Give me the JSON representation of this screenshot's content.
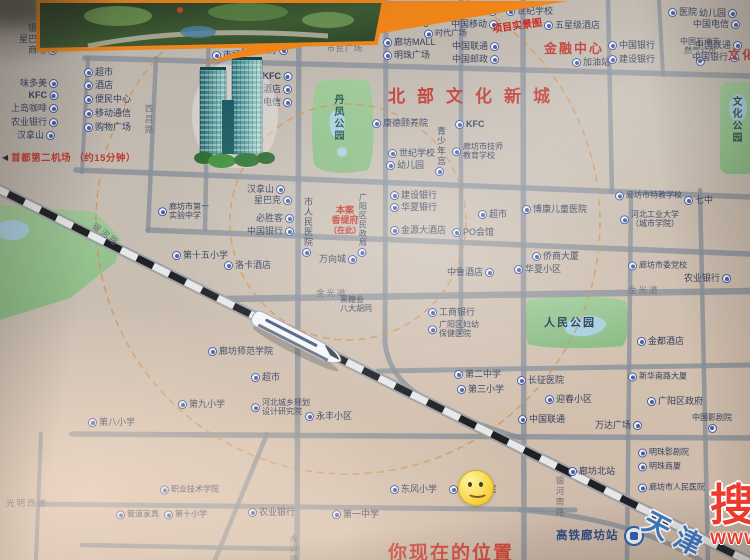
{
  "colors": {
    "red": "#bf3931",
    "poi": "#333f5e",
    "road": "#878e98",
    "park": "#92c38c",
    "pond": "#a8cfe0",
    "orange": "#ef8519",
    "rail_black": "#1f2023",
    "watermark_red": "#ea3b2e",
    "direction_blue": "#3c79c4"
  },
  "titles": {
    "admin": "行政中心",
    "finance": "金融中心",
    "north": "北部文化新城",
    "culture": "文化中心",
    "plaza": "市民广场"
  },
  "star_icon": "★",
  "airport": {
    "arrow": "◀",
    "text": "首都第二机场 （约15分钟）"
  },
  "project": {
    "l1": "本案",
    "l2": "香缇府",
    "l3": "（在此）"
  },
  "parks": {
    "danfeng": "丹凤公园",
    "renmin": "人民公园",
    "wenhua": "文化公园"
  },
  "station": {
    "name": "高铁廊坊站"
  },
  "direction": {
    "name": "天津"
  },
  "location": {
    "text": "你现在的位置"
  },
  "watermark": {
    "char": "搜",
    "www": "WWW"
  },
  "callout": {
    "caption": "项目实景图"
  },
  "streets": [
    {
      "t": "西昌路",
      "x": 143,
      "y": 104,
      "v": 1
    },
    {
      "t": "银河路",
      "x": 97,
      "y": 220,
      "r": 38
    },
    {
      "t": "金光道",
      "x": 316,
      "y": 287
    },
    {
      "t": "金光道",
      "x": 628,
      "y": 284
    },
    {
      "t": "永兴路",
      "x": 288,
      "y": 534,
      "v": 1
    },
    {
      "t": "银河南路",
      "x": 554,
      "y": 476,
      "v": 1
    },
    {
      "t": "光明西道",
      "x": 6,
      "y": 497
    }
  ],
  "pois": [
    {
      "x": 57,
      "y": 29,
      "t": "银行",
      "d": "r"
    },
    {
      "x": 57,
      "y": 40,
      "t": "星巴克",
      "d": "r"
    },
    {
      "x": 57,
      "y": 51,
      "t": "商场",
      "d": "r"
    },
    {
      "x": 86,
      "y": 30,
      "t": "世纪华联",
      "d": "l"
    },
    {
      "x": 86,
      "y": 43,
      "t": "超市",
      "d": "l"
    },
    {
      "x": 190,
      "y": 32,
      "t": "超市",
      "d": "l"
    },
    {
      "x": 212,
      "y": 44,
      "t": "便民中心",
      "d": "l"
    },
    {
      "x": 212,
      "y": 56,
      "t": "市场",
      "d": "l"
    },
    {
      "x": 84,
      "y": 73,
      "t": "超市",
      "d": "l"
    },
    {
      "x": 84,
      "y": 86,
      "t": "酒店",
      "d": "l"
    },
    {
      "x": 58,
      "y": 84,
      "t": "味多美",
      "d": "r"
    },
    {
      "x": 58,
      "y": 96,
      "t": "KFC",
      "d": "r",
      "b": 1
    },
    {
      "x": 58,
      "y": 109,
      "t": "上岛咖啡",
      "d": "r"
    },
    {
      "x": 58,
      "y": 123,
      "t": "农业银行",
      "d": "r"
    },
    {
      "x": 55,
      "y": 136,
      "t": "汉拿山",
      "d": "r"
    },
    {
      "x": 84,
      "y": 100,
      "t": "便民中心",
      "d": "l"
    },
    {
      "x": 84,
      "y": 114,
      "t": "移动通信",
      "d": "l"
    },
    {
      "x": 84,
      "y": 128,
      "t": "购物广场",
      "d": "l"
    },
    {
      "x": 288,
      "y": 10,
      "t": "中国银行",
      "d": "r"
    },
    {
      "x": 288,
      "y": 23,
      "t": "KFC",
      "d": "r",
      "b": 1
    },
    {
      "x": 288,
      "y": 37,
      "t": "上岛咖啡",
      "d": "r"
    },
    {
      "x": 288,
      "y": 51,
      "t": "交通银行",
      "d": "r"
    },
    {
      "x": 292,
      "y": 77,
      "t": "KFC",
      "d": "r",
      "b": 1
    },
    {
      "x": 292,
      "y": 90,
      "t": "酒店",
      "d": "r"
    },
    {
      "x": 292,
      "y": 103,
      "t": "电信",
      "d": "r"
    },
    {
      "x": 383,
      "y": 11,
      "t": "如家酒店",
      "d": "l",
      "s": 1
    },
    {
      "x": 425,
      "y": 11,
      "t": "超市",
      "d": "l",
      "s": 1
    },
    {
      "x": 497,
      "y": 12,
      "t": "幼儿园",
      "d": "r"
    },
    {
      "x": 383,
      "y": 24,
      "t": "便民中心",
      "d": "l"
    },
    {
      "x": 498,
      "y": 25,
      "t": "中国移动",
      "d": "r"
    },
    {
      "x": 424,
      "y": 34,
      "t": "时代广场",
      "d": "l",
      "s": 1
    },
    {
      "x": 383,
      "y": 43,
      "t": "廊坊MALL",
      "d": "l"
    },
    {
      "x": 499,
      "y": 47,
      "t": "中国联通",
      "d": "r"
    },
    {
      "x": 383,
      "y": 56,
      "t": "明珠广场",
      "d": "l"
    },
    {
      "x": 499,
      "y": 60,
      "t": "中国邮政",
      "d": "r"
    },
    {
      "x": 506,
      "y": 12,
      "t": "世纪学校",
      "d": "l"
    },
    {
      "x": 544,
      "y": 26,
      "t": "五星级酒店",
      "d": "l"
    },
    {
      "x": 572,
      "y": 63,
      "t": "加油站",
      "d": "l"
    },
    {
      "x": 668,
      "y": 13,
      "t": "医院",
      "d": "l"
    },
    {
      "x": 608,
      "y": 46,
      "t": "中国银行",
      "d": "l"
    },
    {
      "x": 608,
      "y": 60,
      "t": "建设银行",
      "d": "l"
    },
    {
      "x": 700,
      "y": 38,
      "l": [
        "中国石油天",
        "然气公司"
      ],
      "d": "b",
      "s": 1
    },
    {
      "x": 737,
      "y": 14,
      "t": "幼儿园",
      "d": "r"
    },
    {
      "x": 740,
      "y": 25,
      "t": "中国电信",
      "d": "r"
    },
    {
      "x": 742,
      "y": 46,
      "t": "中国联通",
      "d": "r"
    },
    {
      "x": 739,
      "y": 58,
      "t": "中国银行",
      "d": "r"
    },
    {
      "x": 372,
      "y": 124,
      "t": "康德颐养院",
      "d": "l"
    },
    {
      "x": 455,
      "y": 125,
      "t": "KFC",
      "d": "l",
      "b": 1
    },
    {
      "x": 440,
      "y": 126,
      "t": "青少年宫",
      "d": "b",
      "v": 1
    },
    {
      "x": 388,
      "y": 154,
      "t": "世纪学校",
      "d": "l"
    },
    {
      "x": 386,
      "y": 166,
      "t": "幼儿园",
      "d": "l"
    },
    {
      "x": 452,
      "y": 152,
      "l": [
        "廊坊市技师",
        "教育学校"
      ],
      "d": "l",
      "s": 1
    },
    {
      "x": 158,
      "y": 212,
      "l": [
        "廊坊市第一",
        "实验中学"
      ],
      "d": "l",
      "s": 1
    },
    {
      "x": 172,
      "y": 256,
      "t": "第十五小学",
      "d": "l"
    },
    {
      "x": 208,
      "y": 352,
      "t": "廊坊师范学院",
      "d": "l"
    },
    {
      "x": 285,
      "y": 190,
      "t": "汉拿山",
      "d": "r"
    },
    {
      "x": 292,
      "y": 201,
      "t": "星巴克",
      "d": "r"
    },
    {
      "x": 294,
      "y": 219,
      "t": "必胜客",
      "d": "r"
    },
    {
      "x": 294,
      "y": 232,
      "t": "中国银行",
      "d": "r"
    },
    {
      "x": 307,
      "y": 197,
      "t": "市人民医院",
      "v": 1,
      "d": "b"
    },
    {
      "x": 362,
      "y": 193,
      "t": "广阳区民政局",
      "v": 1,
      "d": "b",
      "s": 1
    },
    {
      "x": 390,
      "y": 196,
      "t": "建设银行",
      "d": "l"
    },
    {
      "x": 390,
      "y": 208,
      "t": "华夏银行",
      "d": "l"
    },
    {
      "x": 390,
      "y": 231,
      "t": "金源大酒店",
      "d": "l"
    },
    {
      "x": 452,
      "y": 233,
      "t": "PO会馆",
      "d": "l"
    },
    {
      "x": 224,
      "y": 266,
      "t": "洛卡酒店",
      "d": "l"
    },
    {
      "x": 357,
      "y": 260,
      "t": "万向城",
      "d": "r"
    },
    {
      "x": 478,
      "y": 215,
      "t": "超市",
      "d": "l"
    },
    {
      "x": 494,
      "y": 273,
      "t": "中鲁酒店",
      "d": "r"
    },
    {
      "x": 340,
      "y": 305,
      "l": [
        "黑糖会",
        "八大胡同"
      ],
      "d": "n",
      "s": 1
    },
    {
      "x": 428,
      "y": 313,
      "t": "工商银行",
      "d": "l"
    },
    {
      "x": 428,
      "y": 330,
      "l": [
        "广阳区妇幼",
        "保健医院"
      ],
      "d": "l",
      "s": 1
    },
    {
      "x": 522,
      "y": 210,
      "t": "博康儿童医院",
      "d": "l"
    },
    {
      "x": 615,
      "y": 196,
      "t": "廊坊市特教学校",
      "d": "l",
      "s": 1
    },
    {
      "x": 684,
      "y": 201,
      "t": "七中",
      "d": "l"
    },
    {
      "x": 620,
      "y": 220,
      "l": [
        "河北工业大学",
        "（城市学院）"
      ],
      "d": "l",
      "s": 1
    },
    {
      "x": 532,
      "y": 257,
      "t": "侨商大厦",
      "d": "l"
    },
    {
      "x": 514,
      "y": 270,
      "t": "华夏小区",
      "d": "l"
    },
    {
      "x": 628,
      "y": 266,
      "t": "廊坊市委党校",
      "d": "l",
      "s": 1
    },
    {
      "x": 731,
      "y": 279,
      "t": "农业银行",
      "d": "r"
    },
    {
      "x": 637,
      "y": 342,
      "t": "金都酒店",
      "d": "l"
    },
    {
      "x": 454,
      "y": 375,
      "t": "第二中学",
      "d": "l"
    },
    {
      "x": 457,
      "y": 390,
      "t": "第三小学",
      "d": "l"
    },
    {
      "x": 517,
      "y": 381,
      "t": "长征医院",
      "d": "l"
    },
    {
      "x": 628,
      "y": 377,
      "t": "新华南路大厦",
      "d": "l",
      "s": 1
    },
    {
      "x": 545,
      "y": 400,
      "t": "迎春小区",
      "d": "l"
    },
    {
      "x": 647,
      "y": 402,
      "t": "广阳区政府",
      "d": "l"
    },
    {
      "x": 518,
      "y": 420,
      "t": "中国联通",
      "d": "l"
    },
    {
      "x": 642,
      "y": 426,
      "t": "万达广场",
      "d": "r"
    },
    {
      "x": 712,
      "y": 414,
      "t": "中国影剧院",
      "d": "b",
      "s": 1
    },
    {
      "x": 305,
      "y": 417,
      "t": "永丰小区",
      "d": "l"
    },
    {
      "x": 251,
      "y": 408,
      "l": [
        "河北城乡规划",
        "设计研究院"
      ],
      "d": "l",
      "s": 1
    },
    {
      "x": 251,
      "y": 378,
      "t": "超市",
      "d": "l"
    },
    {
      "x": 178,
      "y": 405,
      "t": "第九小学",
      "d": "l"
    },
    {
      "x": 88,
      "y": 423,
      "t": "第八小学",
      "d": "l"
    },
    {
      "x": 160,
      "y": 490,
      "t": "职业技术学院",
      "d": "l",
      "s": 1
    },
    {
      "x": 116,
      "y": 515,
      "t": "管道家具",
      "d": "l",
      "s": 1
    },
    {
      "x": 164,
      "y": 515,
      "t": "第十小学",
      "d": "l",
      "s": 1
    },
    {
      "x": 248,
      "y": 513,
      "t": "农业银行",
      "d": "l"
    },
    {
      "x": 332,
      "y": 515,
      "t": "第一中学",
      "d": "l"
    },
    {
      "x": 390,
      "y": 490,
      "t": "东风小学",
      "d": "l"
    },
    {
      "x": 449,
      "y": 490,
      "t": "安次医院",
      "d": "l"
    },
    {
      "x": 568,
      "y": 472,
      "t": "廊坊北站",
      "d": "l"
    },
    {
      "x": 638,
      "y": 453,
      "t": "明珠影剧院",
      "d": "l",
      "s": 1
    },
    {
      "x": 638,
      "y": 467,
      "t": "明珠商厦",
      "d": "l",
      "s": 1
    },
    {
      "x": 638,
      "y": 488,
      "t": "廊坊市人民医院",
      "d": "l",
      "s": 1
    }
  ]
}
